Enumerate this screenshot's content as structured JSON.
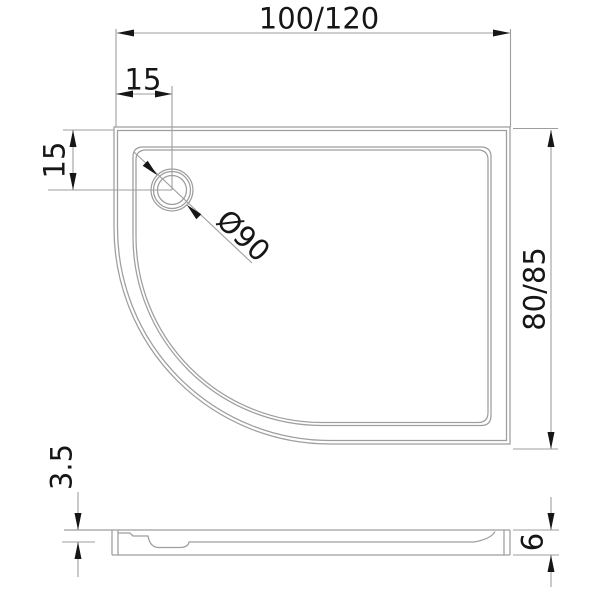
{
  "drawing_title": "offset quadrant shower tray dimension drawing",
  "colors": {
    "line": "#9e9e9e",
    "ink": "#161616",
    "bg": "#ffffff"
  },
  "labels": {
    "width": "100/120",
    "drain_offset_x": "15",
    "drain_offset_y": "15",
    "drain_diameter": "Ø90",
    "depth": "80/85",
    "basin_depth": "3.5",
    "total_height": "6"
  }
}
